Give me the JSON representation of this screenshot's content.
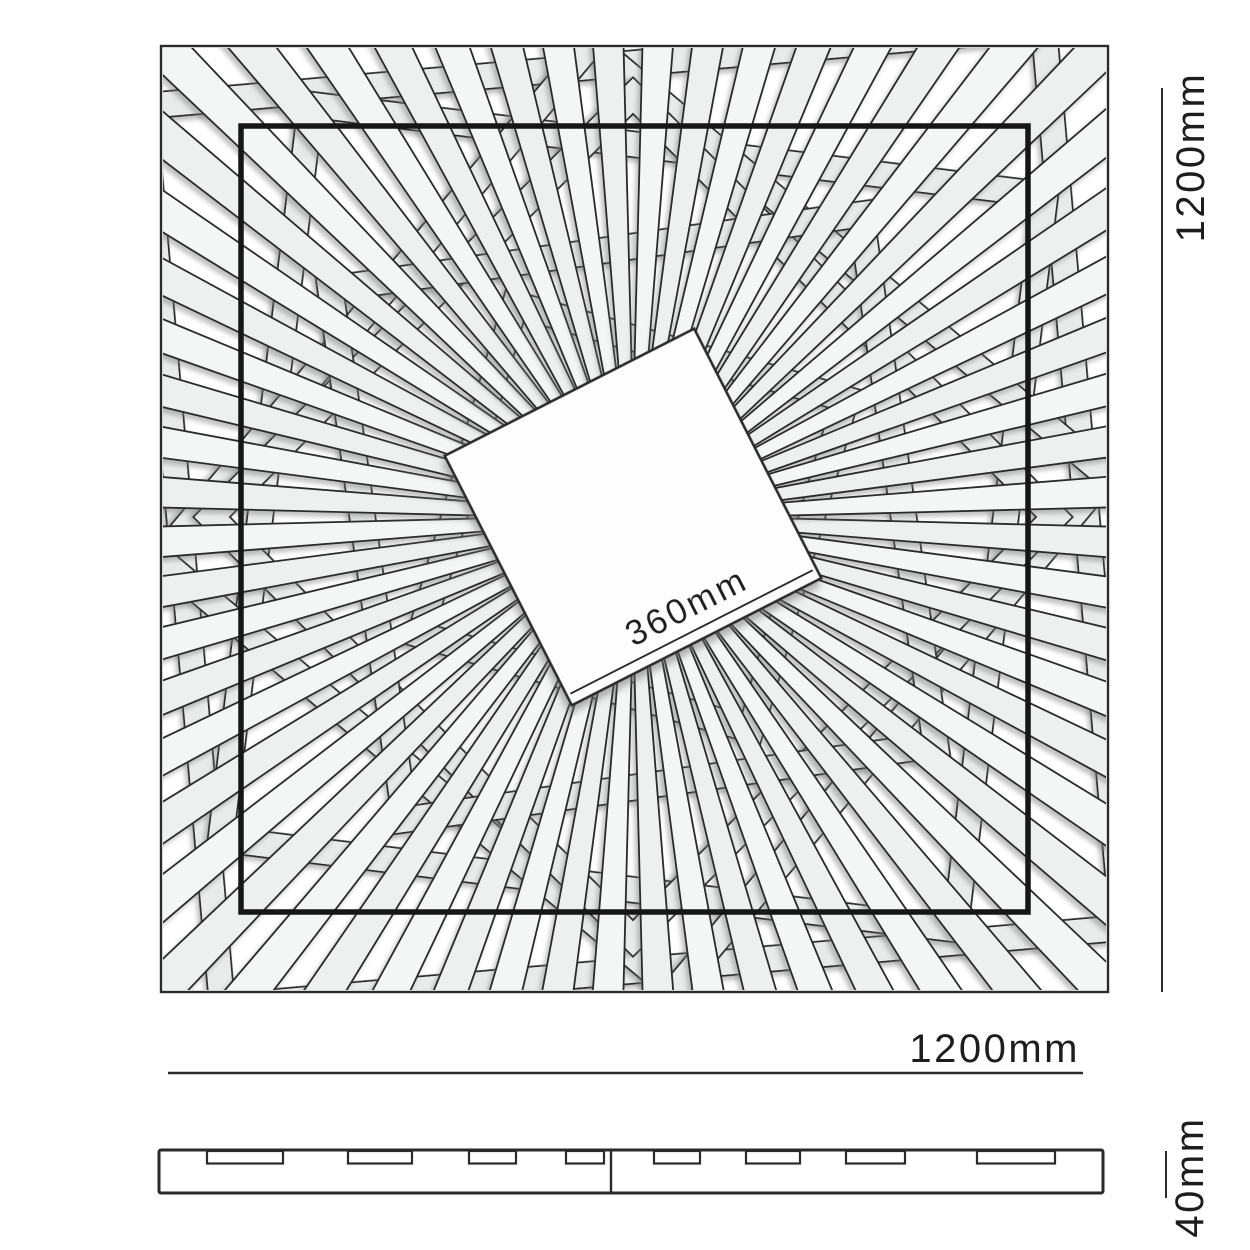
{
  "diagram": {
    "title": "Square sunburst wall panel dimension drawing",
    "top_view": {
      "height_label": "1200mm",
      "width_label": "1200mm",
      "center_label": "360mm"
    },
    "side_view": {
      "thickness_label": "40mm",
      "notches": [
        {
          "x": 207,
          "w": 76
        },
        {
          "x": 348,
          "w": 64
        },
        {
          "x": 469,
          "w": 47
        },
        {
          "x": 566,
          "w": 38
        },
        {
          "x": 654,
          "w": 46
        },
        {
          "x": 746,
          "w": 54
        },
        {
          "x": 846,
          "w": 59
        },
        {
          "x": 977,
          "w": 78
        }
      ]
    },
    "colors": {
      "line": "#2a2a2a",
      "bold_line": "#161616",
      "slat_fill_a": "#f4f5f5",
      "slat_fill_b": "#eef0f0",
      "ring_fill": "#e9ebeb",
      "background": "#ffffff",
      "shadow": "#777777"
    },
    "artwork": {
      "center": [
        633,
        517
      ],
      "ray_count": 60,
      "ray_angle_offset": 3,
      "ray_inner_radius": 50,
      "ray_outer_radius": 700,
      "ray_half_width_base": 2.5,
      "ray_half_width_slope": 0.027,
      "band_width": 24,
      "rings": [
        {
          "half": 452,
          "rot": -5
        },
        {
          "half": 370,
          "rot": 7
        },
        {
          "half": 336,
          "rot": 40
        },
        {
          "half": 298,
          "rot": 45
        },
        {
          "half": 268,
          "rot": -8
        },
        {
          "half": 172,
          "rot": 16
        }
      ]
    }
  }
}
